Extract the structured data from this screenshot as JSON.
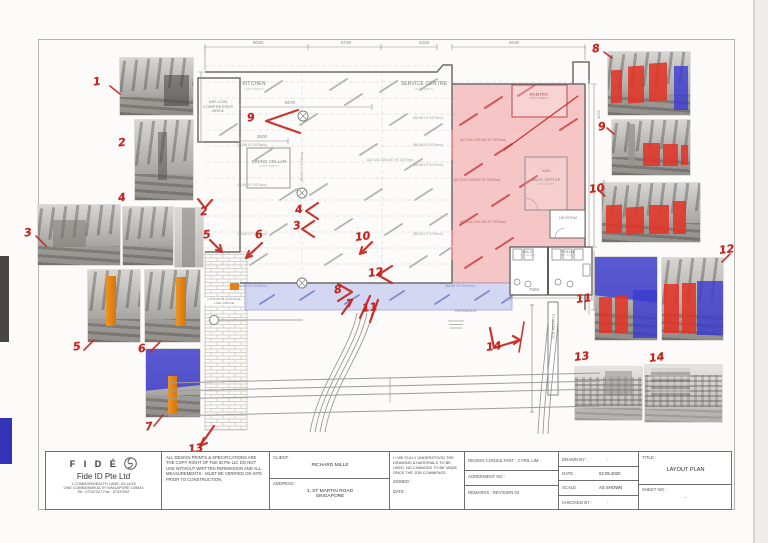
{
  "nums": {
    "n1": "1",
    "n2": "2",
    "n3": "3",
    "n4": "4",
    "n5": "5",
    "n6": "6",
    "n7": "7",
    "n8": "8",
    "n9": "9",
    "n10": "10",
    "n11": "11",
    "n12": "12",
    "n13": "13",
    "n14": "14"
  },
  "plan": {
    "dims": {
      "d8030": "8030",
      "d5700": "5700",
      "d4425": "4425",
      "d4630": "4630",
      "d6670": "6670",
      "d3600": "3600",
      "d7965": "7965",
      "d3450": "3450",
      "d2935": "2935",
      "d4130": "4130"
    },
    "rooms": {
      "aircon": "AIR-CON\nCOMPRESSER\nAREA",
      "kitchen": "KITCHEN",
      "kitchen_area": "(XXX SQFT)",
      "service": "SERVICE CENTRE",
      "service_area": "(XXX SQFT)",
      "dining": "DINING CELLAR",
      "dining_area": "(XXX SQFT)",
      "pantry": "PANTRY",
      "pantry_area": "(XXX SQFT)",
      "back_office": "BACK OFFICE",
      "back_office_area": "(XXX SQFT)",
      "db_room": "DB ROOM",
      "male": "MALE",
      "male_area": "(XX SQFT)",
      "female": "FEMALE",
      "female_area": "(XX SQFT)",
      "entrance": "ENTRANCE",
      "planter": "PLANTER BOX",
      "signage": "OUTDOOR SIGNAGE\nLINE ABOVE"
    },
    "notes": {
      "beam": "(BEAM HT 3470mm)",
      "beam_blue": "(BEAM HT 4000mm)",
      "ceiling": "(ACTUAL CEILING HT 3070mm)"
    }
  },
  "title_block": {
    "logo_text": "F I D É",
    "company": "Fide ID Pte Ltd",
    "addr1": "1 COMMONWEALTH LANE, 04-14/15",
    "addr2": "ONE COMMONWEALTH SINGAPORE 149544",
    "tel": "Tel : 67337227      Fax : 67337657",
    "copyright": "ALL DESIGN PRINTS & SPECIFICATIONS ARE THE COPY RIGHT OF Fide ID Pte Ltd. DO NOT USE WITHOUT WRITTEN PERMISSION AND ALL MEASUREMENTS - MUST BE VERIFIED ON SITE PRIOR TO CONSTRUCTION.",
    "client_label": "CLIENT :",
    "client": "RICHARD MILLE",
    "address_label": "ADDRESS :",
    "address": "1, ST MARTIN ROAD\nSINGAPORE",
    "declaration": "I / WE FULLY UNDERSTOOD THE DRAWING & MATERIALS TO BE USED, NO CHANGES TO BE MADE ONCE THE JOB COMMENCE.",
    "signed_label": "SIGNED :",
    "date_label": "DATE :",
    "consultant": "DESIGN CONSULTANT :  CYRIL LIM",
    "agreement": "AGREEMENT NO :",
    "remarks": "REMARKS :    REVISION 02",
    "drawn_by_label": "DRAWN BY :",
    "drawn_by": "-",
    "date2_label": "DATE :",
    "date_value": "02.09.2020",
    "scale_label": "SCALE :",
    "scale_value": "AS SHOWN",
    "checked_label": "CHECKED BY :",
    "checked_value": "-",
    "title_label": "TITLE :",
    "title_value": "LAYOUT PLAN",
    "sheet_label": "SHEET NO :",
    "sheet_value": "-"
  }
}
